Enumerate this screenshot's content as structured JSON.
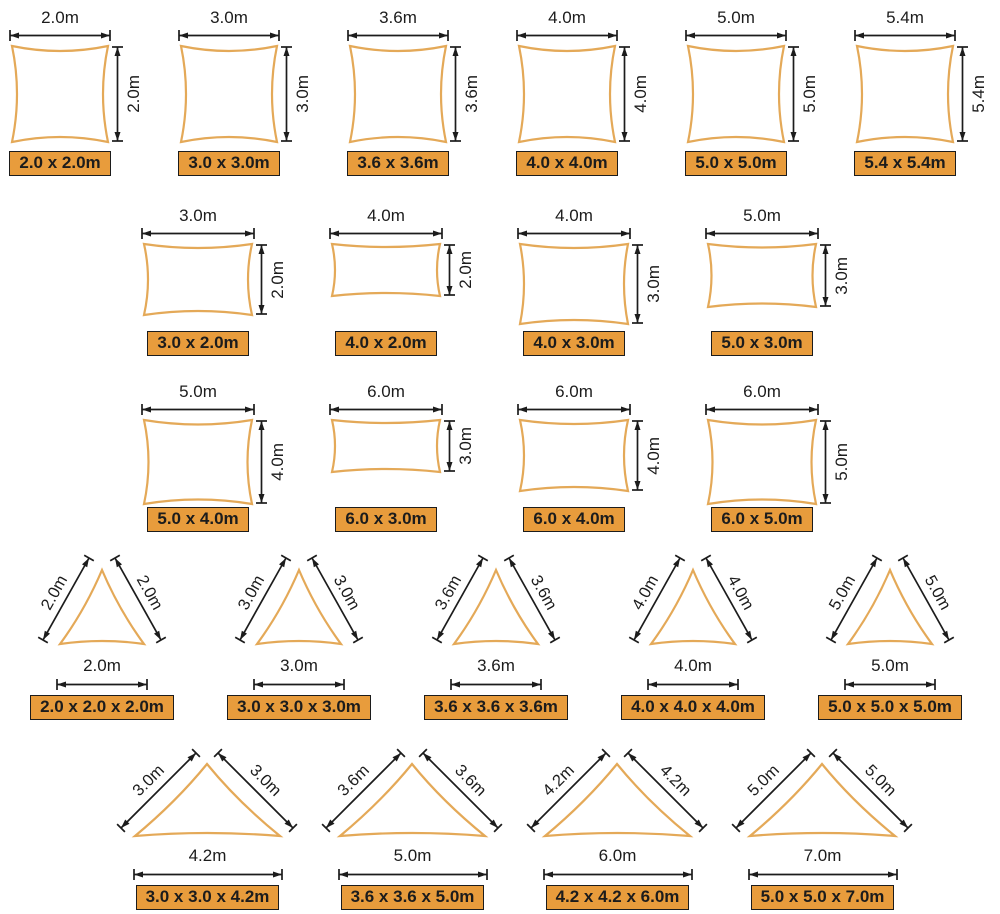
{
  "colors": {
    "background": "#ffffff",
    "sail_stroke": "#E4A958",
    "badge_bg": "#E89C3C",
    "badge_border": "#1c1c1c",
    "dim": "#1c1c1c"
  },
  "rows": [
    {
      "type": "quad",
      "items": [
        {
          "w": 2.0,
          "h": 2.0,
          "top_label": "2.0m",
          "side_label": "2.0m",
          "badge": "2.0 x 2.0m"
        },
        {
          "w": 3.0,
          "h": 3.0,
          "top_label": "3.0m",
          "side_label": "3.0m",
          "badge": "3.0 x 3.0m"
        },
        {
          "w": 3.6,
          "h": 3.6,
          "top_label": "3.6m",
          "side_label": "3.6m",
          "badge": "3.6 x 3.6m"
        },
        {
          "w": 4.0,
          "h": 4.0,
          "top_label": "4.0m",
          "side_label": "4.0m",
          "badge": "4.0 x 4.0m"
        },
        {
          "w": 5.0,
          "h": 5.0,
          "top_label": "5.0m",
          "side_label": "5.0m",
          "badge": "5.0 x 5.0m"
        },
        {
          "w": 5.4,
          "h": 5.4,
          "top_label": "5.4m",
          "side_label": "5.4m",
          "badge": "5.4 x 5.4m"
        }
      ]
    },
    {
      "type": "quad",
      "items": [
        {
          "w": 3.0,
          "h": 2.0,
          "top_label": "3.0m",
          "side_label": "2.0m",
          "badge": "3.0 x 2.0m"
        },
        {
          "w": 4.0,
          "h": 2.0,
          "top_label": "4.0m",
          "side_label": "2.0m",
          "badge": "4.0 x 2.0m"
        },
        {
          "w": 4.0,
          "h": 3.0,
          "top_label": "4.0m",
          "side_label": "3.0m",
          "badge": "4.0 x 3.0m"
        },
        {
          "w": 5.0,
          "h": 3.0,
          "top_label": "5.0m",
          "side_label": "3.0m",
          "badge": "5.0 x 3.0m"
        }
      ]
    },
    {
      "type": "quad",
      "items": [
        {
          "w": 5.0,
          "h": 4.0,
          "top_label": "5.0m",
          "side_label": "4.0m",
          "badge": "5.0 x 4.0m"
        },
        {
          "w": 6.0,
          "h": 3.0,
          "top_label": "6.0m",
          "side_label": "3.0m",
          "badge": "6.0 x 3.0m"
        },
        {
          "w": 6.0,
          "h": 4.0,
          "top_label": "6.0m",
          "side_label": "4.0m",
          "badge": "6.0 x 4.0m"
        },
        {
          "w": 6.0,
          "h": 5.0,
          "top_label": "6.0m",
          "side_label": "5.0m",
          "badge": "6.0 x 5.0m"
        }
      ]
    },
    {
      "type": "tri",
      "items": [
        {
          "side_a": "2.0m",
          "side_b": "2.0m",
          "base_label": "2.0m",
          "badge": "2.0 x 2.0 x 2.0m"
        },
        {
          "side_a": "3.0m",
          "side_b": "3.0m",
          "base_label": "3.0m",
          "badge": "3.0 x 3.0 x 3.0m"
        },
        {
          "side_a": "3.6m",
          "side_b": "3.6m",
          "base_label": "3.6m",
          "badge": "3.6 x 3.6 x 3.6m"
        },
        {
          "side_a": "4.0m",
          "side_b": "4.0m",
          "base_label": "4.0m",
          "badge": "4.0 x 4.0 x 4.0m"
        },
        {
          "side_a": "5.0m",
          "side_b": "5.0m",
          "base_label": "5.0m",
          "badge": "5.0 x 5.0 x 5.0m"
        }
      ]
    },
    {
      "type": "tri_wide",
      "items": [
        {
          "side_a": "3.0m",
          "side_b": "3.0m",
          "base_label": "4.2m",
          "badge": "3.0 x 3.0 x 4.2m"
        },
        {
          "side_a": "3.6m",
          "side_b": "3.6m",
          "base_label": "5.0m",
          "badge": "3.6 x 3.6 x 5.0m"
        },
        {
          "side_a": "4.2m",
          "side_b": "4.2m",
          "base_label": "6.0m",
          "badge": "4.2 x 4.2 x 6.0m"
        },
        {
          "side_a": "5.0m",
          "side_b": "5.0m",
          "base_label": "7.0m",
          "badge": "5.0 x 5.0 x 7.0m"
        }
      ]
    }
  ]
}
